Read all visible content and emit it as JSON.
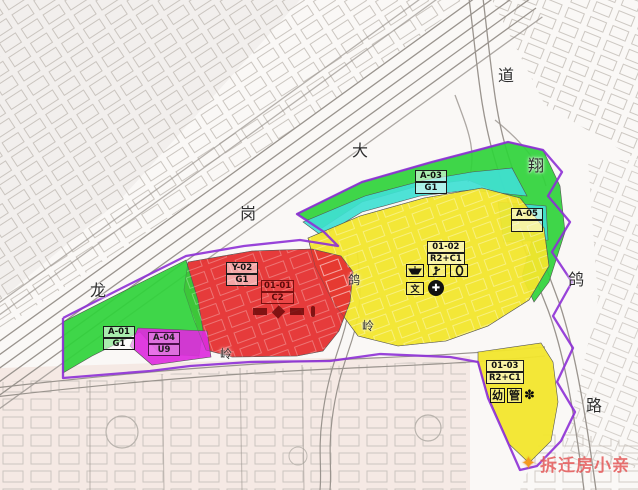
{
  "map": {
    "road_labels": [
      {
        "char": "龙",
        "road": "longgang-avenue"
      },
      {
        "char": "岗",
        "road": "longgang-avenue"
      },
      {
        "char": "大",
        "road": "longgang-avenue"
      },
      {
        "char": "道",
        "road": "longgang-avenue"
      },
      {
        "char": "翔",
        "road": "east-road"
      },
      {
        "char": "鸽",
        "road": "east-road"
      },
      {
        "char": "路",
        "road": "east-road"
      },
      {
        "char": "鸽",
        "road": "middle-road"
      },
      {
        "char": "岭",
        "road": "middle-road"
      },
      {
        "char": "岭",
        "road": "south-road"
      }
    ],
    "parcels": [
      {
        "id": "A-03",
        "code": "G1",
        "zone": "cyan-green-band"
      },
      {
        "id": "A-05",
        "code": "",
        "zone": "cyan-patch"
      },
      {
        "id": "01-02",
        "code": "R2+C1",
        "zone": "yellow-main"
      },
      {
        "id": "Y-02",
        "code": "G1",
        "zone": "green-band-west"
      },
      {
        "id": "01-01",
        "code": "C2",
        "zone": "red"
      },
      {
        "id": "A-01",
        "code": "G1",
        "zone": "green-left"
      },
      {
        "id": "A-04",
        "code": "U9",
        "zone": "magenta"
      },
      {
        "id": "01-03",
        "code": "R2+C1",
        "zone": "yellow-southeast"
      }
    ],
    "facilities": {
      "kindergarten": "幼",
      "management": "管",
      "culture": "文"
    },
    "colors": {
      "residential_yellow": "#f2e62c",
      "commercial_red": "#e53030",
      "green_space": "#2fd33a",
      "canal_cyan": "#3fdfd2",
      "utility_magenta": "#dd2bdd",
      "plan_boundary_purple": "#8d2fd6"
    }
  },
  "watermark": {
    "text": "拆迁房小亲"
  }
}
